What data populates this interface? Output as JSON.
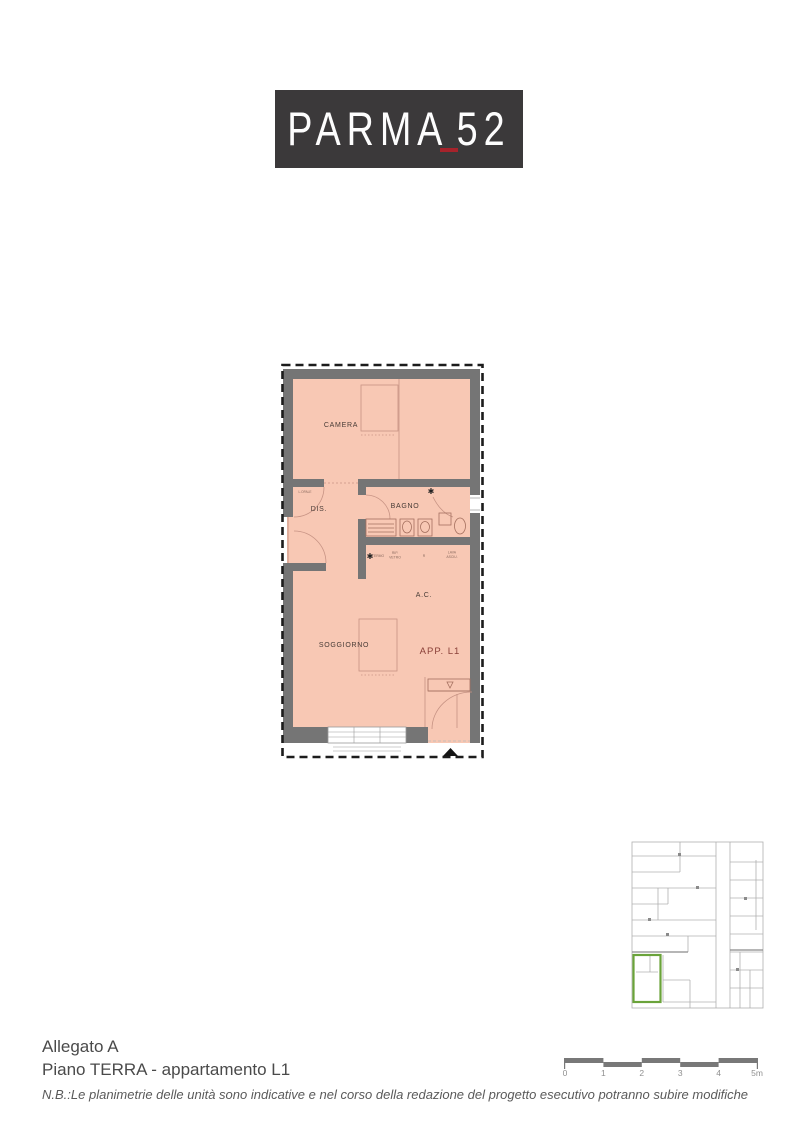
{
  "colors": {
    "logo_bg": "#3b393a",
    "accent_red": "#a6232b",
    "wall_gray": "#757575",
    "room_fill": "#f8c8b4",
    "plan_line": "#c79384",
    "fixture_line": "#a5705f",
    "label_dark": "#473b36",
    "app_label_red": "#8a4038",
    "tiny_label": "#8a6a5e",
    "highlight_green": "#6aa33a",
    "keyplan_line": "#b0b0b0",
    "bar_gray": "#787878",
    "footer_text": "#4a4a4a",
    "note_text": "#5a5a5a"
  },
  "logo": {
    "word": "PARMA",
    "number": "52"
  },
  "floor_plan": {
    "labels": {
      "camera": "CAMERA",
      "dis": "DIS.",
      "bagno": "BAGNO",
      "ac": "A.C.",
      "soggiorno": "SOGGIORNO",
      "apartment": "APP. L1"
    },
    "tiny_labels": {
      "a1": "TERMO",
      "b1": "RIP.",
      "b2": "VETRO",
      "c1": "R",
      "d1": "LAVA",
      "d2": "ASCIU.",
      "e1": "L.OPALE"
    },
    "star": "✱"
  },
  "scale_bar": {
    "labels": [
      "0",
      "1",
      "2",
      "3",
      "4",
      "5m"
    ]
  },
  "footer": {
    "attachment": "Allegato A",
    "floor_apartment": "Piano TERRA - appartamento L1",
    "note": "N.B.:Le planimetrie delle unità sono indicative e nel corso della redazione del progetto esecutivo potranno subire modifiche"
  }
}
